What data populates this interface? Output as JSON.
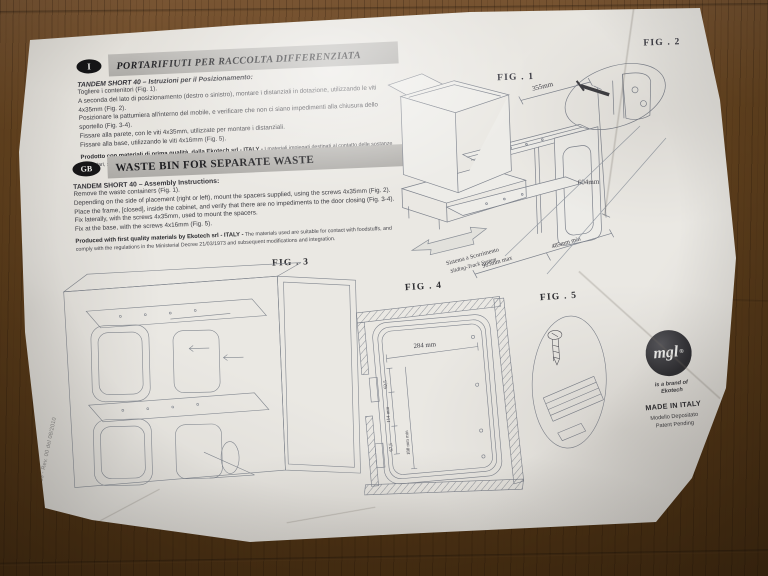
{
  "leaflet": {
    "doc_code": "M3400083 - Rev. 00 del 08/2010",
    "italian": {
      "badge": "I",
      "title": "PORTARIFIUTI PER RACCOLTA DIFFERENZIATA",
      "subtitle": "TANDEM SHORT 40 – Istruzioni per il Posizionamento:",
      "steps": [
        "Togliere i contenitori (Fig. 1).",
        "A seconda del lato di posizionamento (destro o sinistro), montare i distanziali in dotazione, utilizzando le viti 4x35mm (Fig. 2).",
        "Posizionare la pattumiera all'interno del mobile, e verificare che non ci siano impedimenti alla chiusura dello sportello (Fig. 3-4).",
        "Fissare alla parete, con le viti 4x35mm, utilizzate per montare i distanziali.",
        "Fissare alla base, utilizzando le viti 4x16mm (Fig. 5)."
      ],
      "quality_bold": "Prodotto con materiali di prima qualità, dalla Ekotech srl - ITALY -",
      "quality_rest": "I materiali impiegati destinati al contatto delle sostanze alimentari, sono conformi alle prescrizioni contenute nel D.M. 21/03/1973 e successive modifiche/integrazioni."
    },
    "english": {
      "badge": "GB",
      "title": "WASTE BIN FOR SEPARATE WASTE",
      "subtitle": "TANDEM SHORT 40 – Assembly Instructions:",
      "steps": [
        "Remove the waste containers (Fig. 1).",
        "Depending on the side of placement (right or left), mount the spacers supplied, using the screws 4x35mm (Fig. 2).",
        "Place the frame, [closed], inside the cabinet, and verify that there are no impediments to the door closing (Fig. 3-4).",
        "Fix laterally, with the screws 4x35mm, used to mount the spacers.",
        "Fix at the base, with the screws 4x16mm (Fig. 5)."
      ],
      "quality_bold": "Produced with first quality materials by Ekotech srl - ITALY -",
      "quality_rest": "The materials used are suitable for contact with foodstuffs, and comply with the regulations in the Ministerial Decree 21/03/1973 and subsequent modifications and integration."
    },
    "fig1": {
      "label": "FIG . 1",
      "dim_width": "355mm",
      "dim_height": "604mm",
      "dim_depth_max": "985mm max",
      "dim_depth_min": "485mm min",
      "slide_system_it": "Sistema a Scorrimento",
      "slide_system_en": "Sliding-Track System"
    },
    "fig2": {
      "label": "FIG . 2"
    },
    "fig3": {
      "label": "FIG . 3"
    },
    "fig4": {
      "label": "FIG . 4",
      "dim_width": "284 mm",
      "dim_a": "62,5",
      "dim_b": "114 mm",
      "dim_c": "67,5",
      "dim_d": "180 mm min"
    },
    "fig5": {
      "label": "FIG . 5"
    },
    "brand": {
      "logo_text": "mgl",
      "reg_mark": "®",
      "brand_of_line1": "is a brand of",
      "brand_of_line2": "Ekotech",
      "made_in": "MADE IN ITALY",
      "registered_model": "Modello Depositato",
      "patent": "Patent Pending"
    }
  }
}
